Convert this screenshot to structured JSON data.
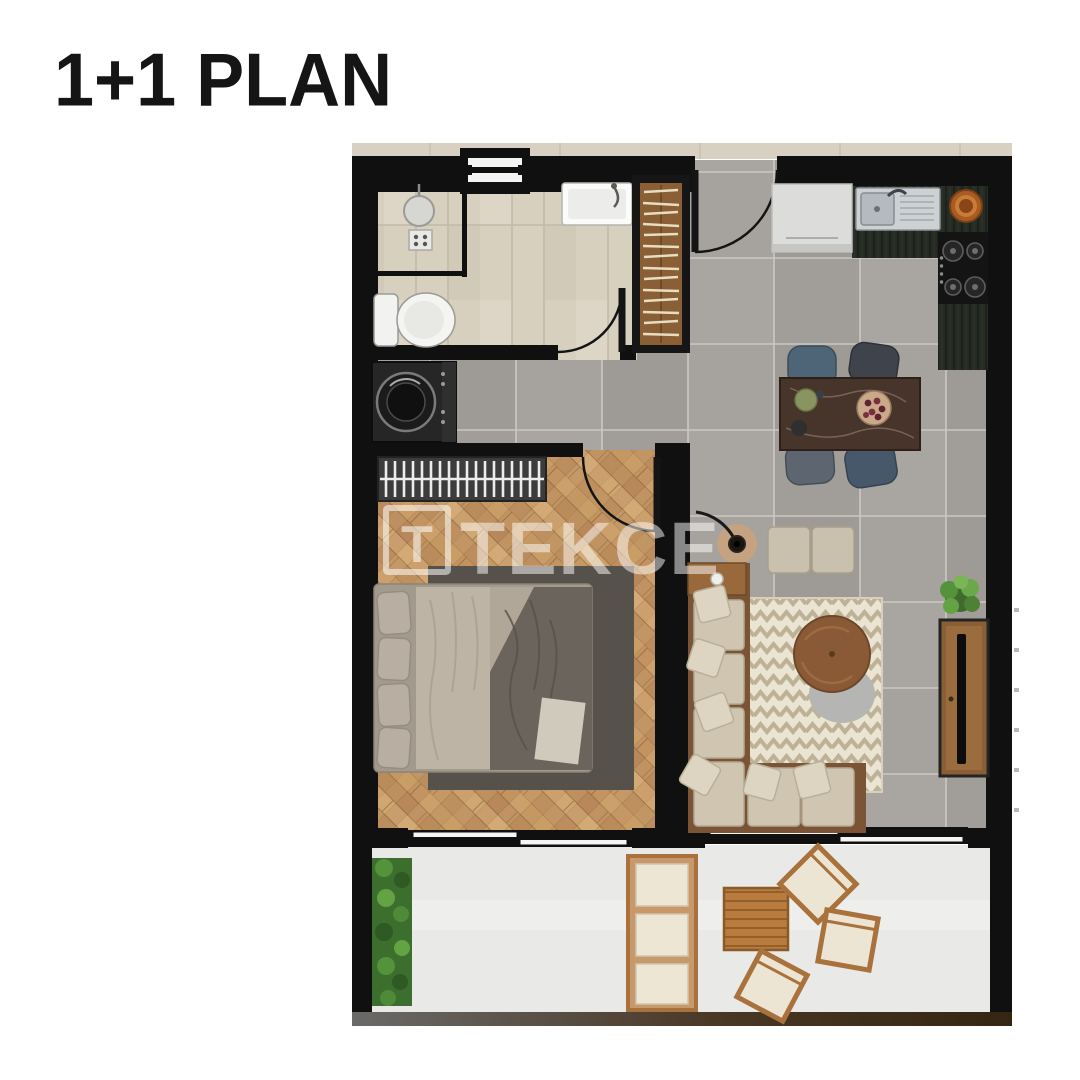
{
  "header": {
    "title": "1+1 PLAN"
  },
  "watermark": {
    "logo_letter": "T",
    "text": "TEKCE"
  },
  "palette": {
    "wall": "#101010",
    "bathroom_tile": "#d8d0bf",
    "concrete_tile": "#a5a19c",
    "bedroom_wood": "#c99b64",
    "terrace_floor": "#e9e9e7",
    "kitchen_counter": "#262b24",
    "sofa_beige": "#cfc5b0",
    "rug_cream": "#ece4d2",
    "furniture_wood": "#8a5f35",
    "copper_accent": "#b5672a",
    "plant_green": "#55923c",
    "dining_table_marble": "#47342a"
  }
}
